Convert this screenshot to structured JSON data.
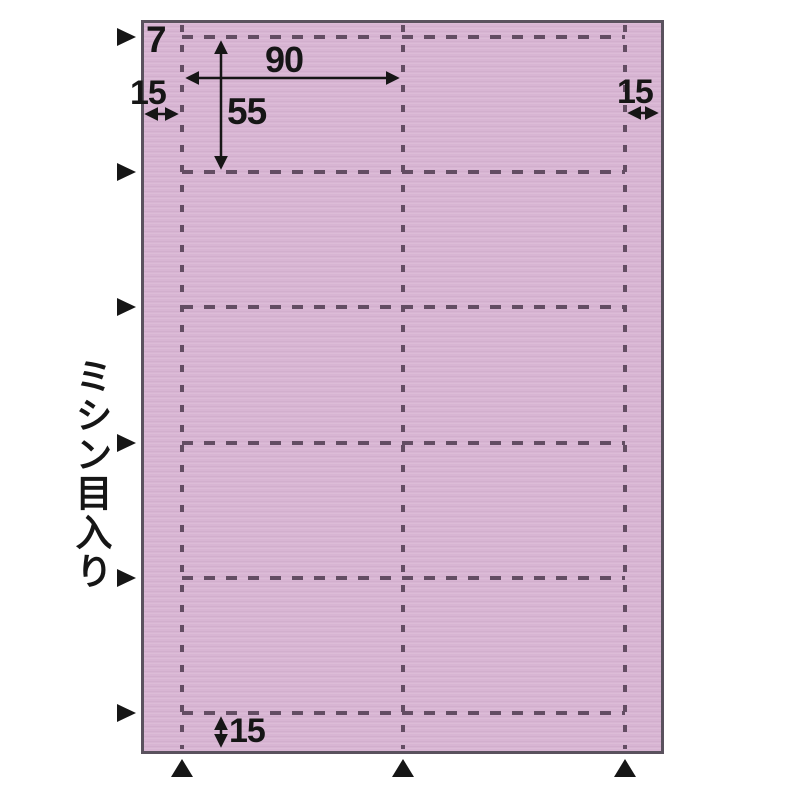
{
  "diagram": {
    "side_note": "ミシン目入り",
    "dimensions": {
      "top_margin": "7",
      "left_margin": "15",
      "right_margin": "15",
      "bottom_margin": "15",
      "card_width": "90",
      "card_height": "55"
    },
    "sheet": {
      "card_columns": 2,
      "card_rows": 5,
      "vertical_perforation_lines": 3,
      "horizontal_perforation_lines": 6,
      "left_alignment_markers": 6,
      "bottom_alignment_markers": 3
    },
    "colors": {
      "background": "#ffffff",
      "sheet_fill": "#d8b5d3",
      "sheet_border": "#5a525e",
      "perforation": "#634d63",
      "ink": "#161616"
    }
  }
}
